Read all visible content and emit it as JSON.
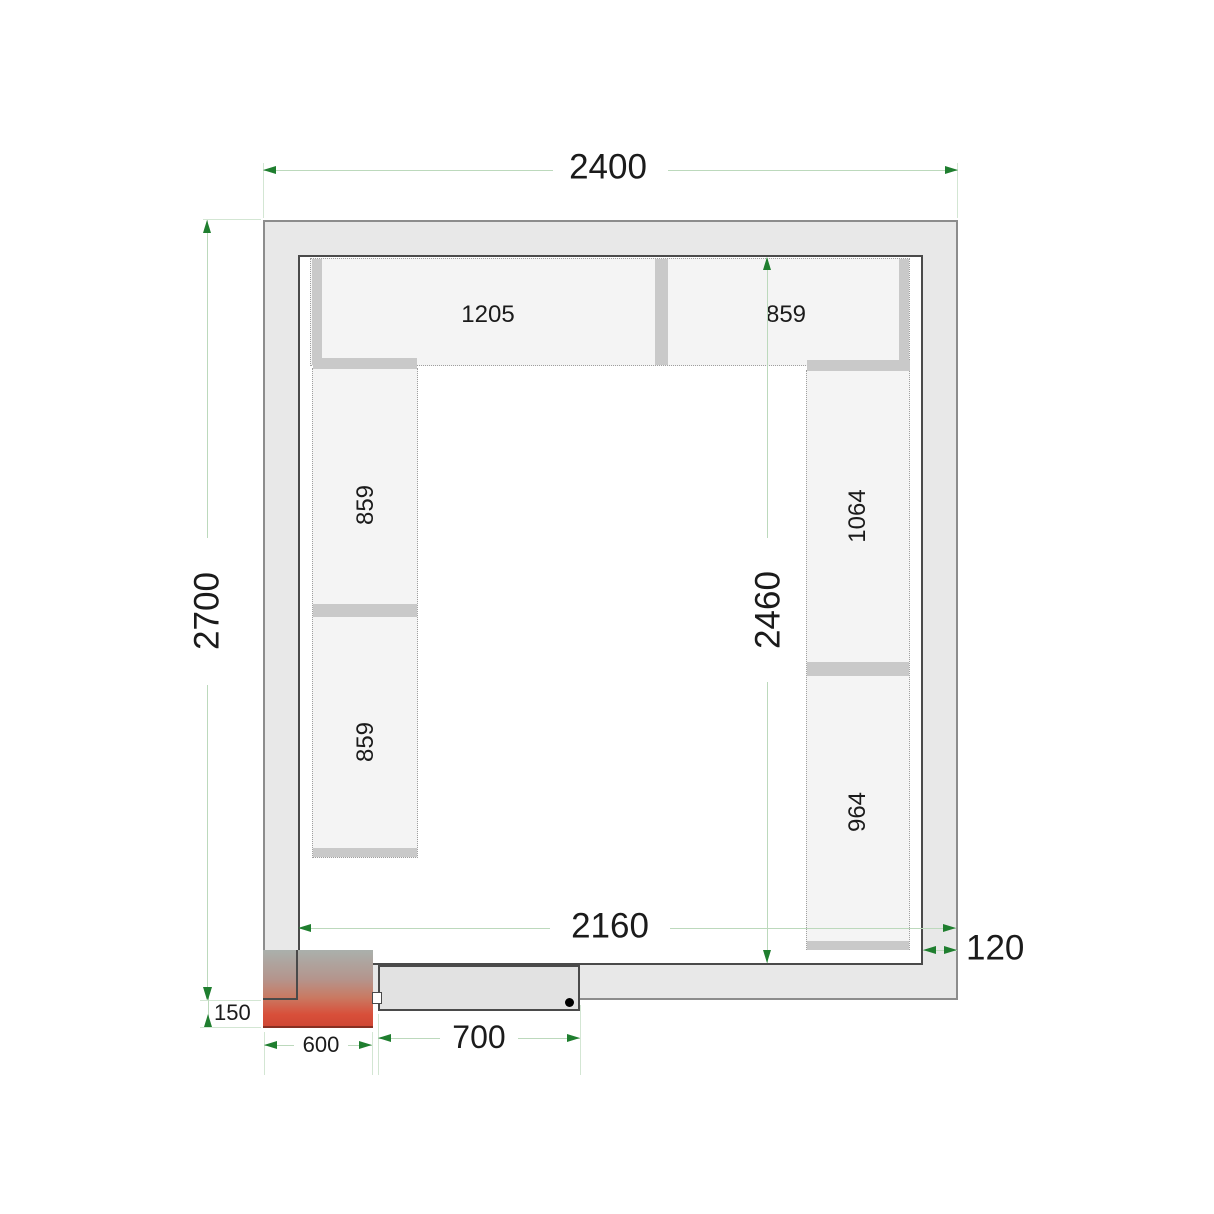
{
  "drawing": {
    "dims": {
      "outer_width": "2400",
      "outer_depth": "2700",
      "inner_width": "2160",
      "inner_depth": "2460",
      "wall_thickness": "120",
      "unit_protrusion": "150",
      "unit_width": "600",
      "door_width": "700"
    },
    "shelves": {
      "top_left": "1205",
      "top_right": "859",
      "left_upper": "859",
      "left_lower": "859",
      "right_upper": "1064",
      "right_lower": "964"
    }
  },
  "colors": {
    "dim_line": "#bcd9bc",
    "ext_line": "#d3e6d3",
    "dim_arrow": "#1f7e2f",
    "wall_fill": "#e8e8e8",
    "wall_edge": "#8c8c8c",
    "inner_edge": "#4a4a4a",
    "shelf_fill": "#f4f4f4",
    "shelf_border": "#9f9f9f",
    "bar_fill": "#c9c9c9",
    "door_fill": "#e2e2e2",
    "unit_red": "#d84f3a",
    "text": "#1b1b1b"
  }
}
